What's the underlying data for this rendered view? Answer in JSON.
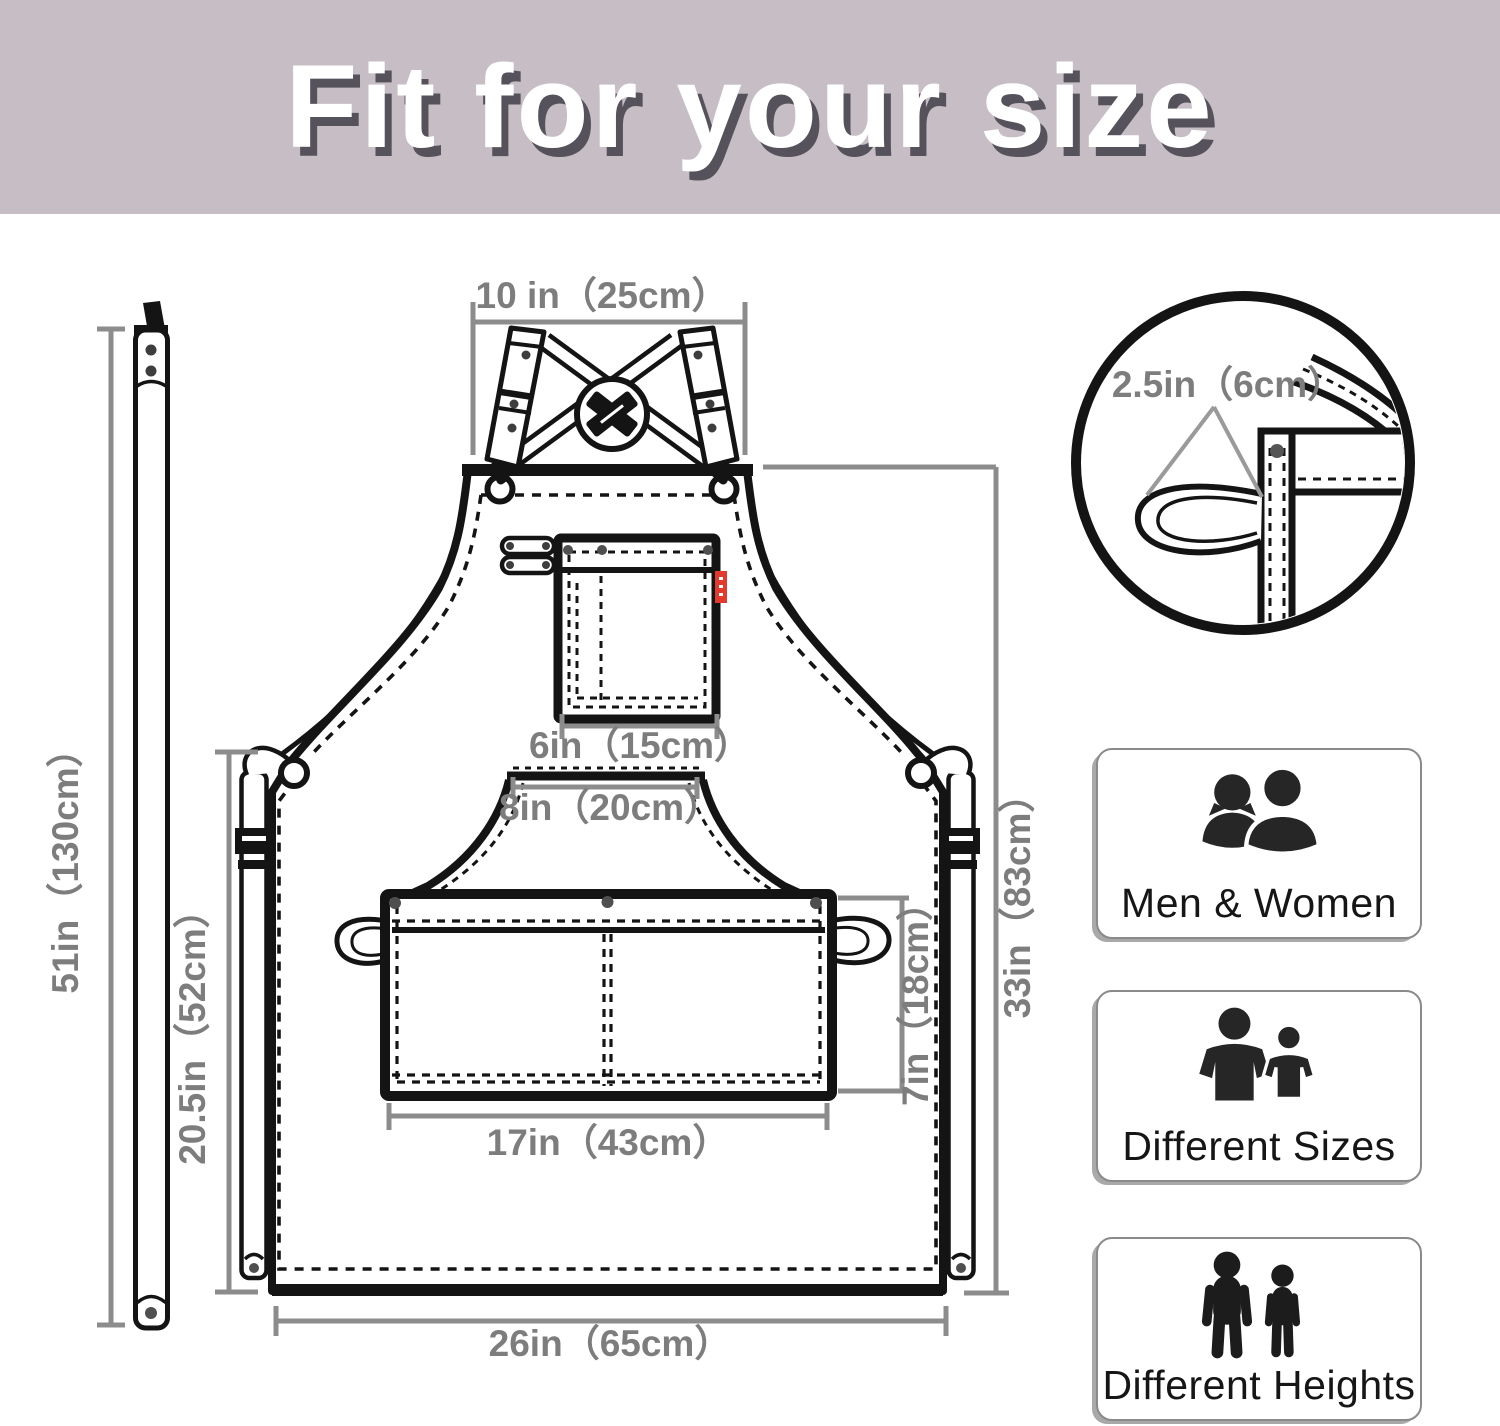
{
  "header": {
    "title": "Fit for your size"
  },
  "dims": {
    "neck": "10 in（25cm）",
    "strap": "51in（130cm）",
    "side": "20.5in（52cm）",
    "chest_pocket": "6in（15cm）",
    "bib_bottom": "8in（20cm）",
    "waist_pocket_w": "17in（43cm）",
    "waist_pocket_d": "7in（18cm）",
    "length": "33in（83cm）",
    "bottom": "26in（65cm）",
    "loop": "2.5in（6cm）"
  },
  "features": [
    {
      "label": "Men & Women",
      "icon": "men-women-icon"
    },
    {
      "label": "Different Sizes",
      "icon": "different-sizes-icon"
    },
    {
      "label": "Different Heights",
      "icon": "different-heights-icon"
    }
  ],
  "colors": {
    "header_bg": "#c6bdc5",
    "title_text": "#ffffff",
    "title_shadow": "#55525b",
    "line": "#141414",
    "dimension": "#8c8c8c",
    "dimension_text": "#7d7d7d",
    "tag_red": "#e23b2e"
  }
}
